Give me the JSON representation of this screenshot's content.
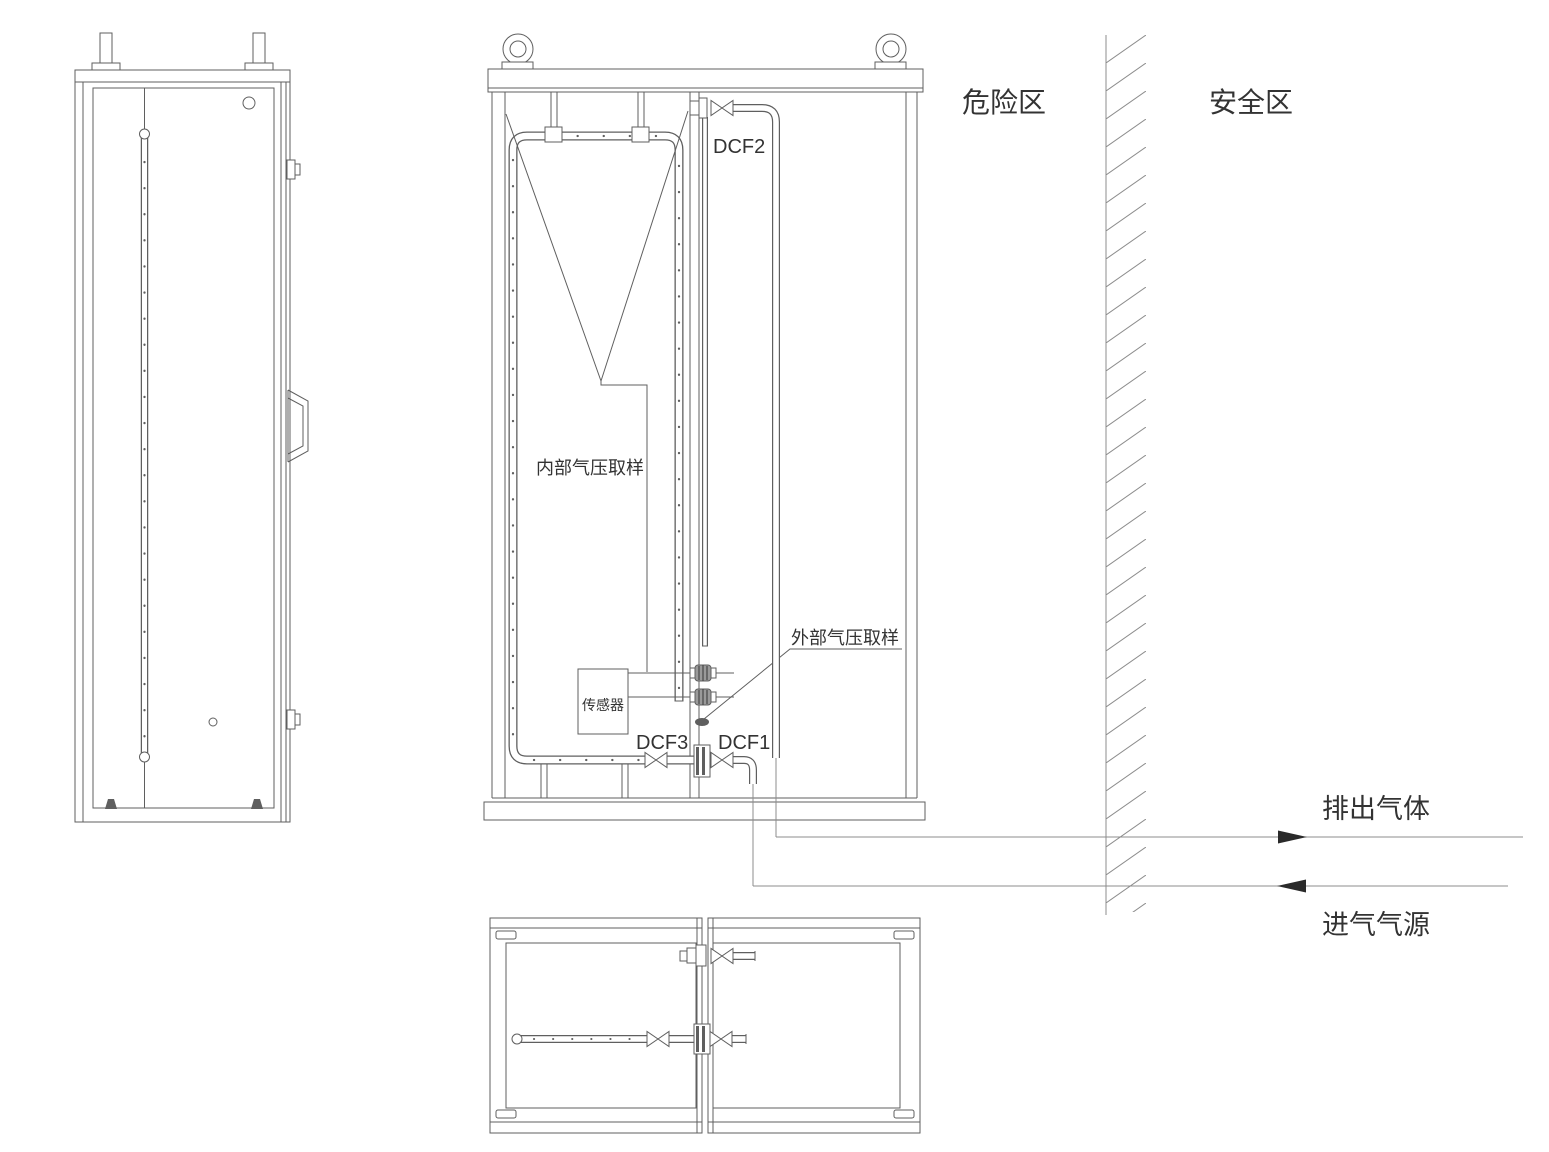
{
  "colors": {
    "line": "#5f5f5f",
    "line_light": "#8c8c8c",
    "text": "#333333",
    "arrow": "#2a2a2a",
    "background": "#ffffff"
  },
  "zones": {
    "hazard": "危险区",
    "safe": "安全区"
  },
  "pipes": {
    "exhaust": "排出气体",
    "intake": "进气气源"
  },
  "cabinet": {
    "valves": {
      "dcf1": "DCF1",
      "dcf2": "DCF2",
      "dcf3": "DCF3"
    },
    "labels": {
      "internal_sampling": "内部气压取样",
      "external_sampling": "外部气压取样",
      "sensor": "传感器"
    }
  }
}
